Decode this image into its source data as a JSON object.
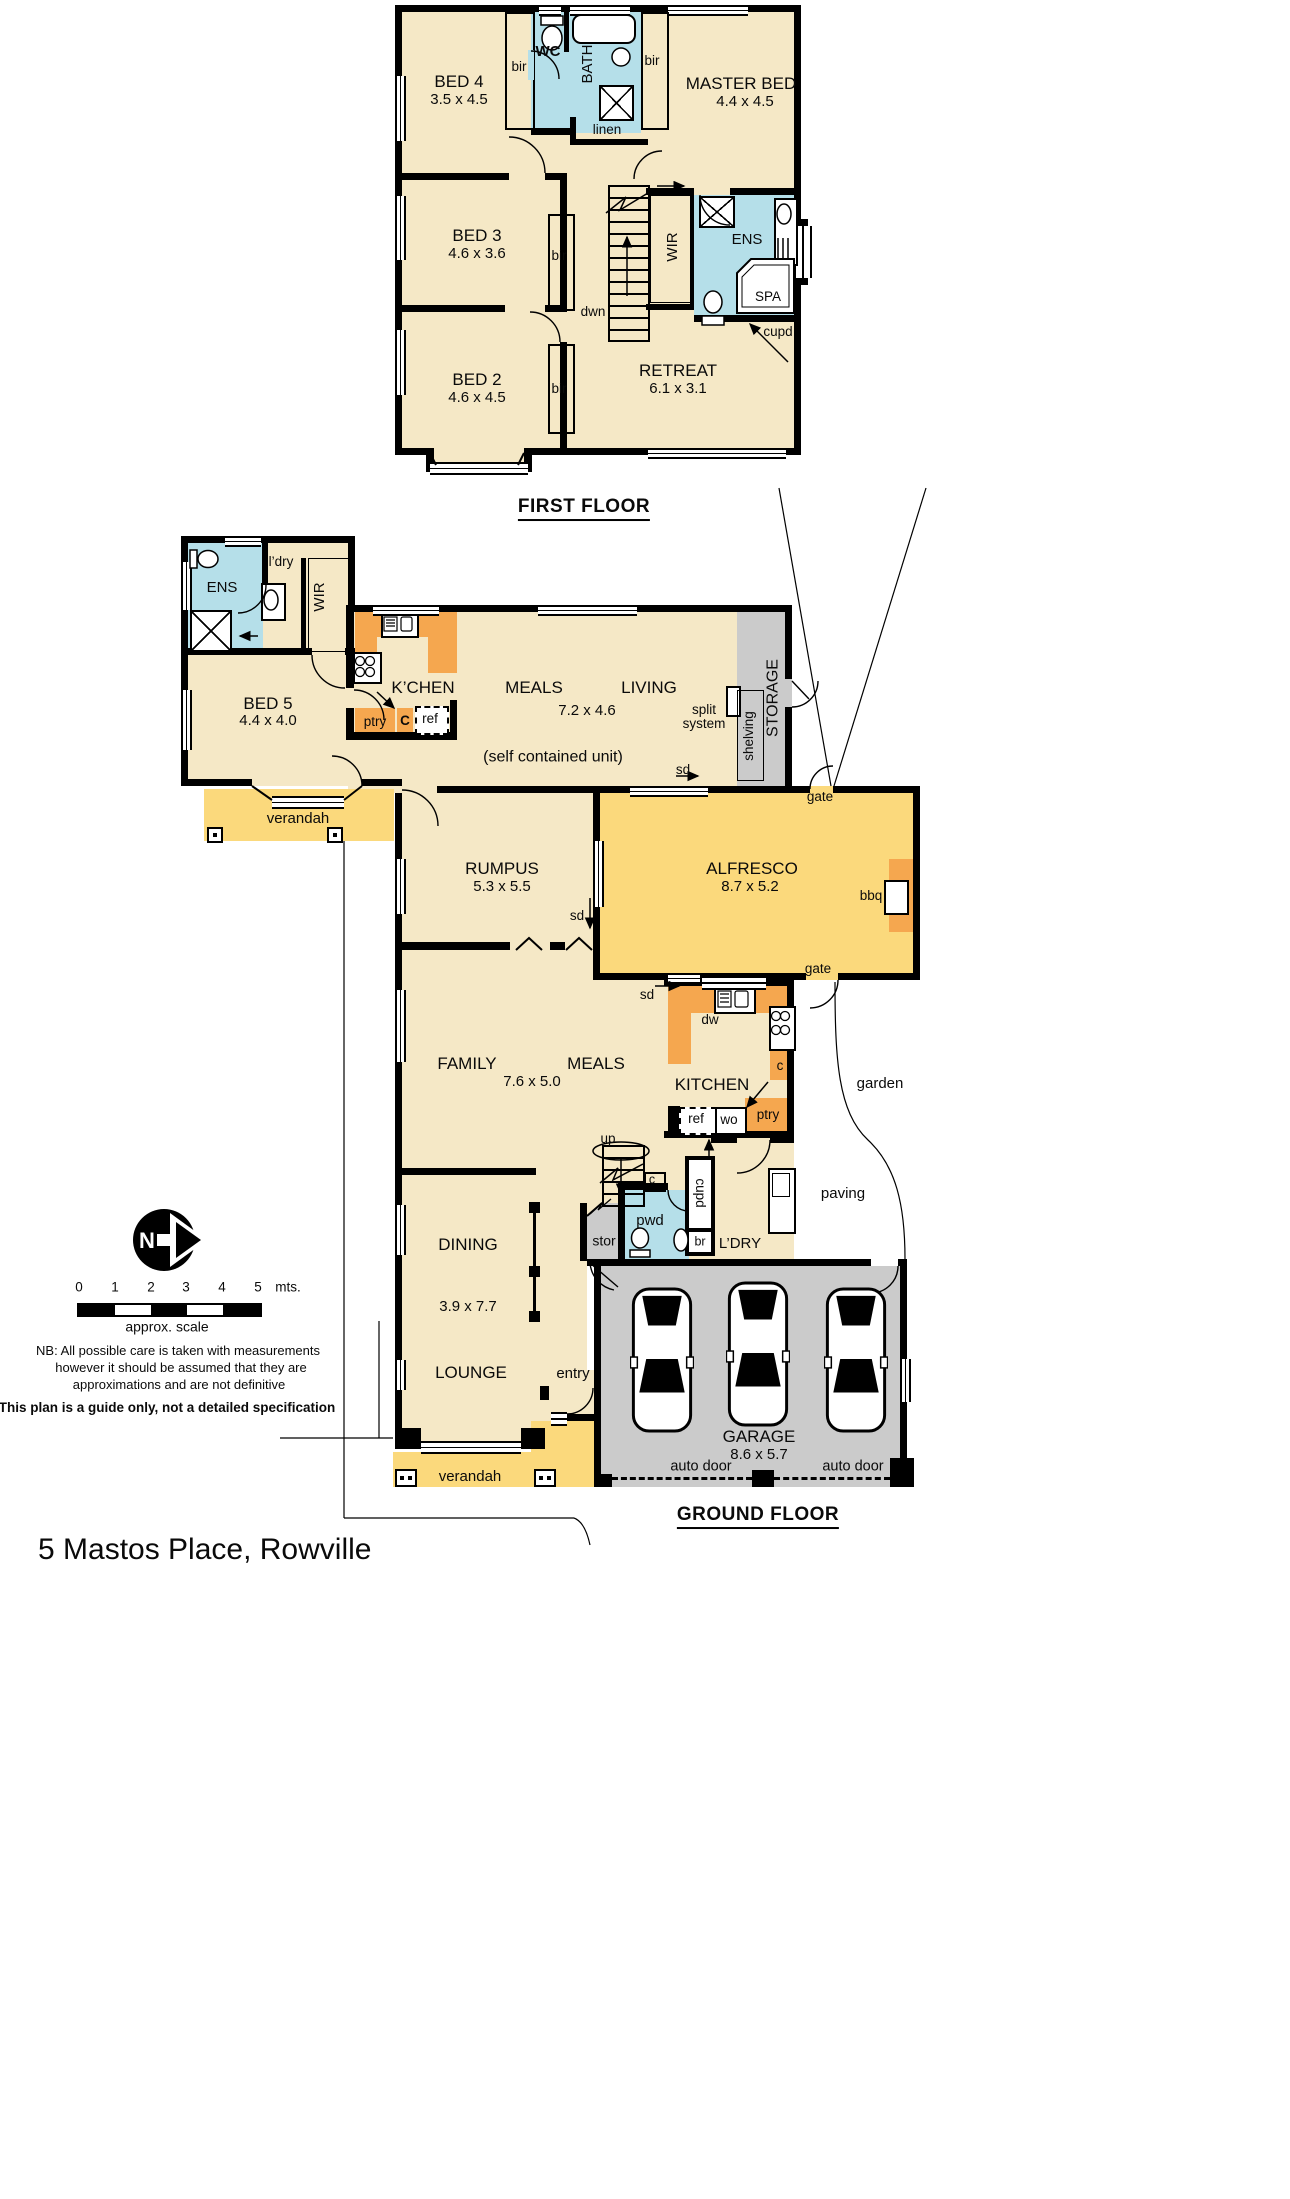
{
  "colors": {
    "room": "#F5E8C6",
    "wet": "#B5DFE9",
    "outdoor": "#FBD97C",
    "bench": "#F5A74F",
    "utility": "#CBCBCB",
    "wall": "#000000"
  },
  "title": "5 Mastos Place, Rowville",
  "ff": {
    "label": "FIRST FLOOR",
    "bed4": {
      "n": "BED 4",
      "d": "3.5 x 4.5"
    },
    "bed3": {
      "n": "BED 3",
      "d": "4.6 x 3.6"
    },
    "bed2": {
      "n": "BED 2",
      "d": "4.6 x 4.5"
    },
    "master": {
      "n": "MASTER BED",
      "d": "4.4 x 4.5"
    },
    "retreat": {
      "n": "RETREAT",
      "d": "6.1 x 3.1"
    },
    "wc": "WC",
    "bath": "BATH",
    "linen": "linen",
    "bir": "bir",
    "wir": "WIR",
    "ens": "ENS",
    "spa": "SPA",
    "cupd": "cupd",
    "dwn": "dwn"
  },
  "gf": {
    "label": "GROUND FLOOR",
    "bed5": {
      "n": "BED 5",
      "d": "4.4 x 4.0"
    },
    "ens": "ENS",
    "ldry_sm": "l’dry",
    "wir": "WIR",
    "kchen": "K’CHEN",
    "ptry": "ptry",
    "c_big": "C",
    "ref": "ref",
    "meals_unit": {
      "n": "MEALS",
      "d": "7.2 x 4.6"
    },
    "living": "LIVING",
    "self_contained": "(self contained unit)",
    "split1": "split",
    "split2": "system",
    "shelving": "shelving",
    "storage": "STORAGE",
    "sd": "sd",
    "gate": "gate",
    "verandah": "verandah",
    "rumpus": {
      "n": "RUMPUS",
      "d": "5.3 x 5.5"
    },
    "alfresco": {
      "n": "ALFRESCO",
      "d": "8.7 x 5.2"
    },
    "bbq": "bbq",
    "family": "FAMILY",
    "meals": "MEALS",
    "family_d": "7.6 x 5.0",
    "kitchen": "KITCHEN",
    "dw": "dw",
    "wo": "wo",
    "c_sm": "c",
    "up": "up",
    "stor": "stor",
    "pwd": "pwd",
    "cupd": "cupd",
    "br": "br",
    "ldry": "L’DRY",
    "garden": "garden",
    "paving": "paving",
    "dining": {
      "n": "DINING",
      "d": "3.9 x 7.7"
    },
    "lounge": "LOUNGE",
    "entry": "entry",
    "garage": {
      "n": "GARAGE",
      "d": "8.6 x 5.7"
    },
    "auto_door": "auto door"
  },
  "notes": {
    "north": "N",
    "scale_ticks": [
      "0",
      "1",
      "2",
      "3",
      "4",
      "5"
    ],
    "scale_unit": "mts.",
    "scale_caption": "approx. scale",
    "nb1": "NB:  All possible care is taken with measurements",
    "nb2": "however it should be assumed that they are",
    "nb3": "approximations and are not definitive",
    "guide": "This plan is a guide only, not a detailed specification"
  }
}
